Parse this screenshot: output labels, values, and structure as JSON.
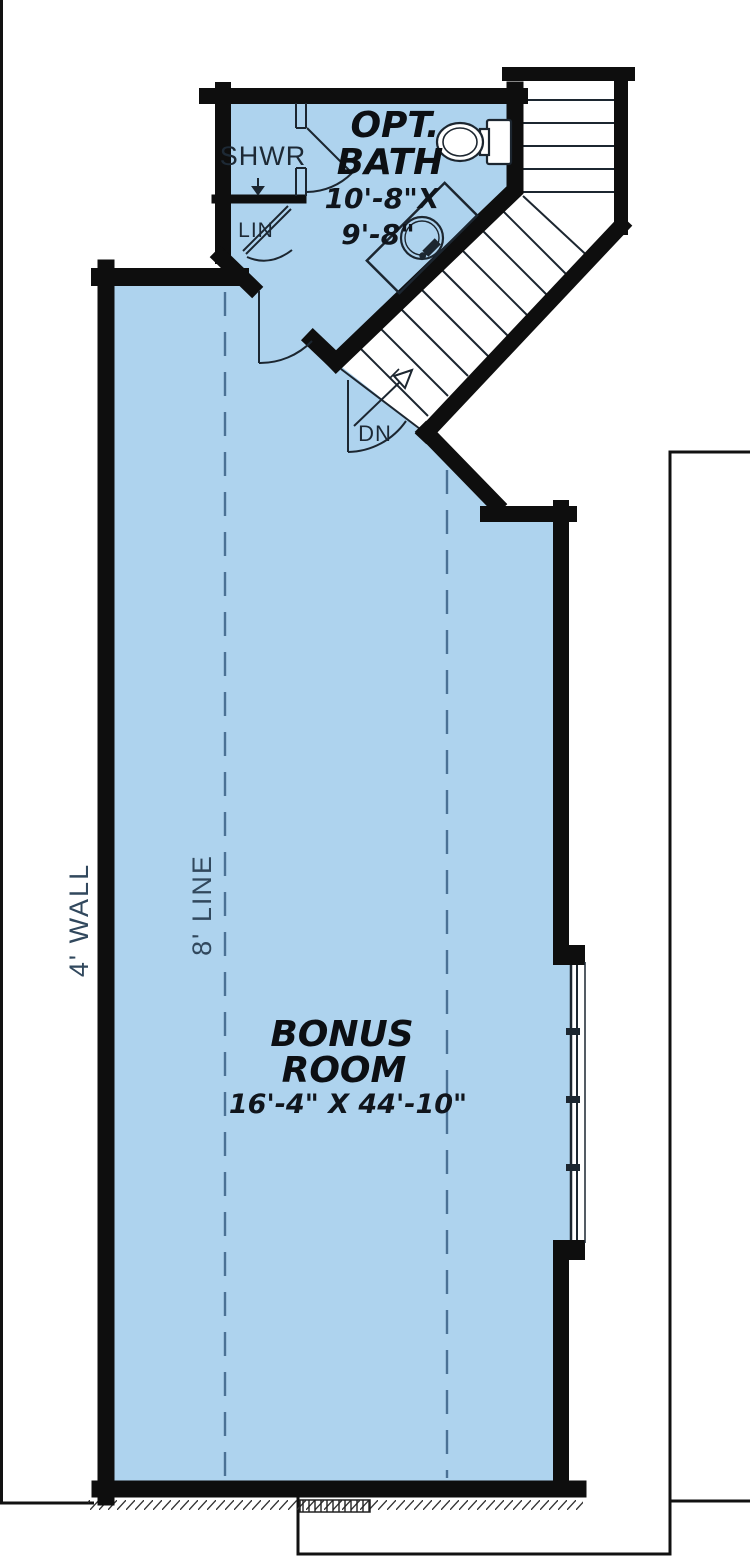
{
  "plan": {
    "title": "bonus-room-floor-plan",
    "labels": {
      "shower": "SHWR",
      "linen": "LIN",
      "bath_name_line1": "OPT.",
      "bath_name_line2": "BATH",
      "bath_dim_line1": "10'-8\"X",
      "bath_dim_line2": "9'-8\"",
      "stairs_down": "DN",
      "bonus_name_line1": "BONUS",
      "bonus_name_line2": "ROOM",
      "bonus_dims": "16'-4\" X 44'-10\"",
      "wall_note": "4' WALL",
      "ceiling_note": "8' LINE"
    },
    "colors": {
      "background": "#ffffff",
      "room_fill": "#aed3ee",
      "wall": "#0e0e0e",
      "fixture_line": "#1c2630",
      "dashed_line": "#4a7195",
      "note_text": "#31485d"
    }
  }
}
